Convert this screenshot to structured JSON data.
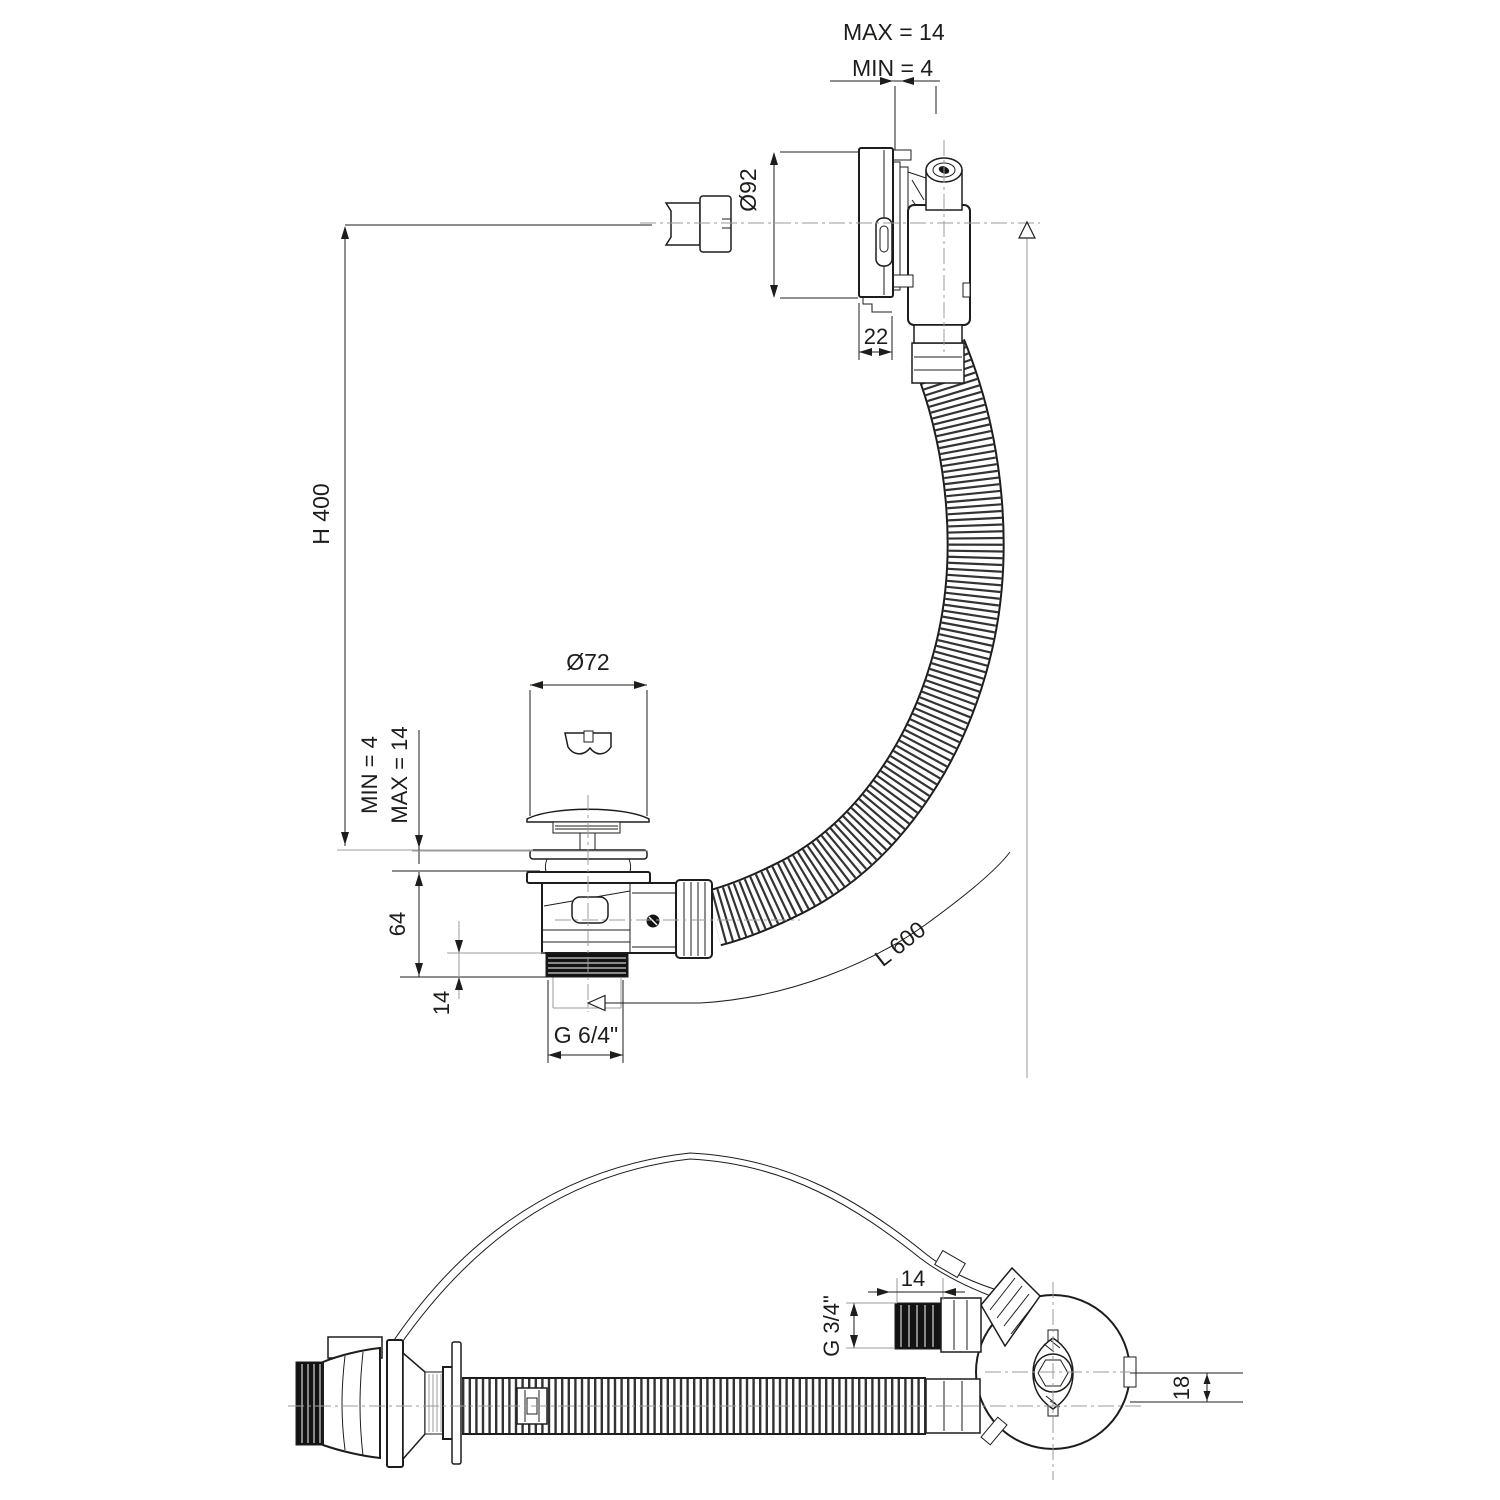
{
  "drawing": {
    "background": "#ffffff",
    "line_color": "#1d1d1b",
    "centerline_color": "#9b9b9b",
    "views": {
      "side": {
        "dims": {
          "max_gap": "MAX = 14",
          "min_gap": "MIN = 4",
          "overflow_diameter": "Ø92",
          "overflow_depth": "22",
          "install_height": "H 400",
          "plug_diameter": "Ø72",
          "plug_min": "MIN = 4",
          "plug_max": "MAX = 14",
          "waste_body_height": "64",
          "waste_thread_length": "14",
          "waste_thread": "G 6/4\"",
          "hose_length": "L 600"
        }
      },
      "plan": {
        "dims": {
          "nipple_length": "14",
          "overflow_thread": "G 3/4\"",
          "rim_thickness": "18"
        }
      }
    }
  }
}
